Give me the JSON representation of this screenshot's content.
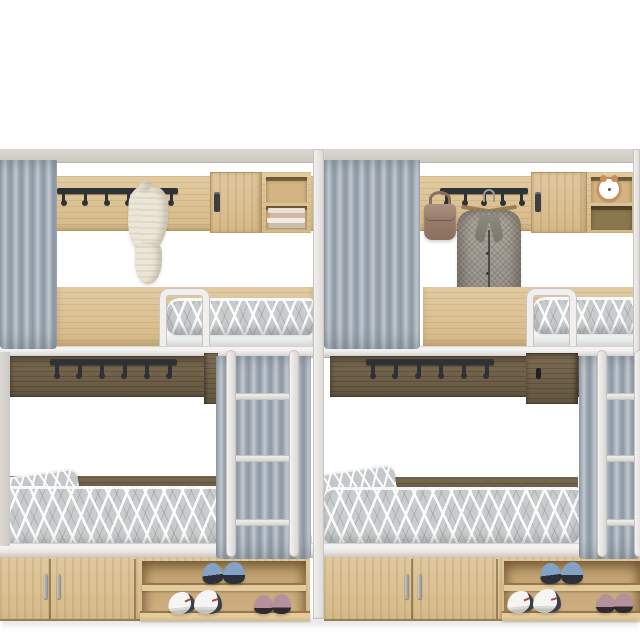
{
  "scene": {
    "type": "3d-product-render",
    "subject": "Two dormitory loft bunk bed units with wardrobe storage, curtains and shoe racks",
    "background": "#ffffff"
  },
  "palette": {
    "wood_light": "#d5b988",
    "wood_light_hi": "#e2cba1",
    "wood_dark": "#635640",
    "frame_white": "#f0efed",
    "beam_grey": "#ccc8c2",
    "curtain_blue_grey": "#a3aeb9",
    "bedding_grey": "#c9cccd",
    "hook_rail": "#2e3135",
    "shoe_blue": "#83a2c6",
    "shoe_white": "#f5f5f3",
    "shoe_mauve": "#b5929b",
    "handbag": "#8a6f5f",
    "blazer": "#96918a",
    "clock_copper": "#c98e5f",
    "towel": "#ece6d8"
  },
  "units": [
    {
      "name": "left bunk unit",
      "wall_rail_hooks": 6,
      "under_bunk_hooks": 6,
      "wall_cabinet": {
        "door": "closed",
        "shelf_top": "empty",
        "shelf_bottom": "stack of books"
      },
      "hanging_items": [
        "white towel"
      ],
      "curtains": [
        "upper bunk curtain",
        "lower bunk curtain"
      ],
      "ladder_rungs": 3,
      "base_cabinet_doors": 2,
      "shoe_rack": {
        "top_shelf": [
          "blue sneakers"
        ],
        "bottom_shelf": [
          "white sneakers",
          "mauve flats"
        ]
      }
    },
    {
      "name": "right bunk unit",
      "wall_rail_hooks": 5,
      "under_bunk_hooks": 6,
      "wall_cabinet": {
        "door": "closed",
        "shelf_top": "copper alarm clock",
        "shelf_bottom": "empty"
      },
      "hanging_items": [
        "taupe handbag",
        "grey herringbone blazer on hanger"
      ],
      "curtains": [
        "upper bunk curtain",
        "lower bunk curtain"
      ],
      "ladder_rungs": 3,
      "base_cabinet_doors": 2,
      "shoe_rack": {
        "top_shelf": [
          "blue sneakers"
        ],
        "bottom_shelf": [
          "white sneakers",
          "mauve flats"
        ]
      }
    }
  ]
}
